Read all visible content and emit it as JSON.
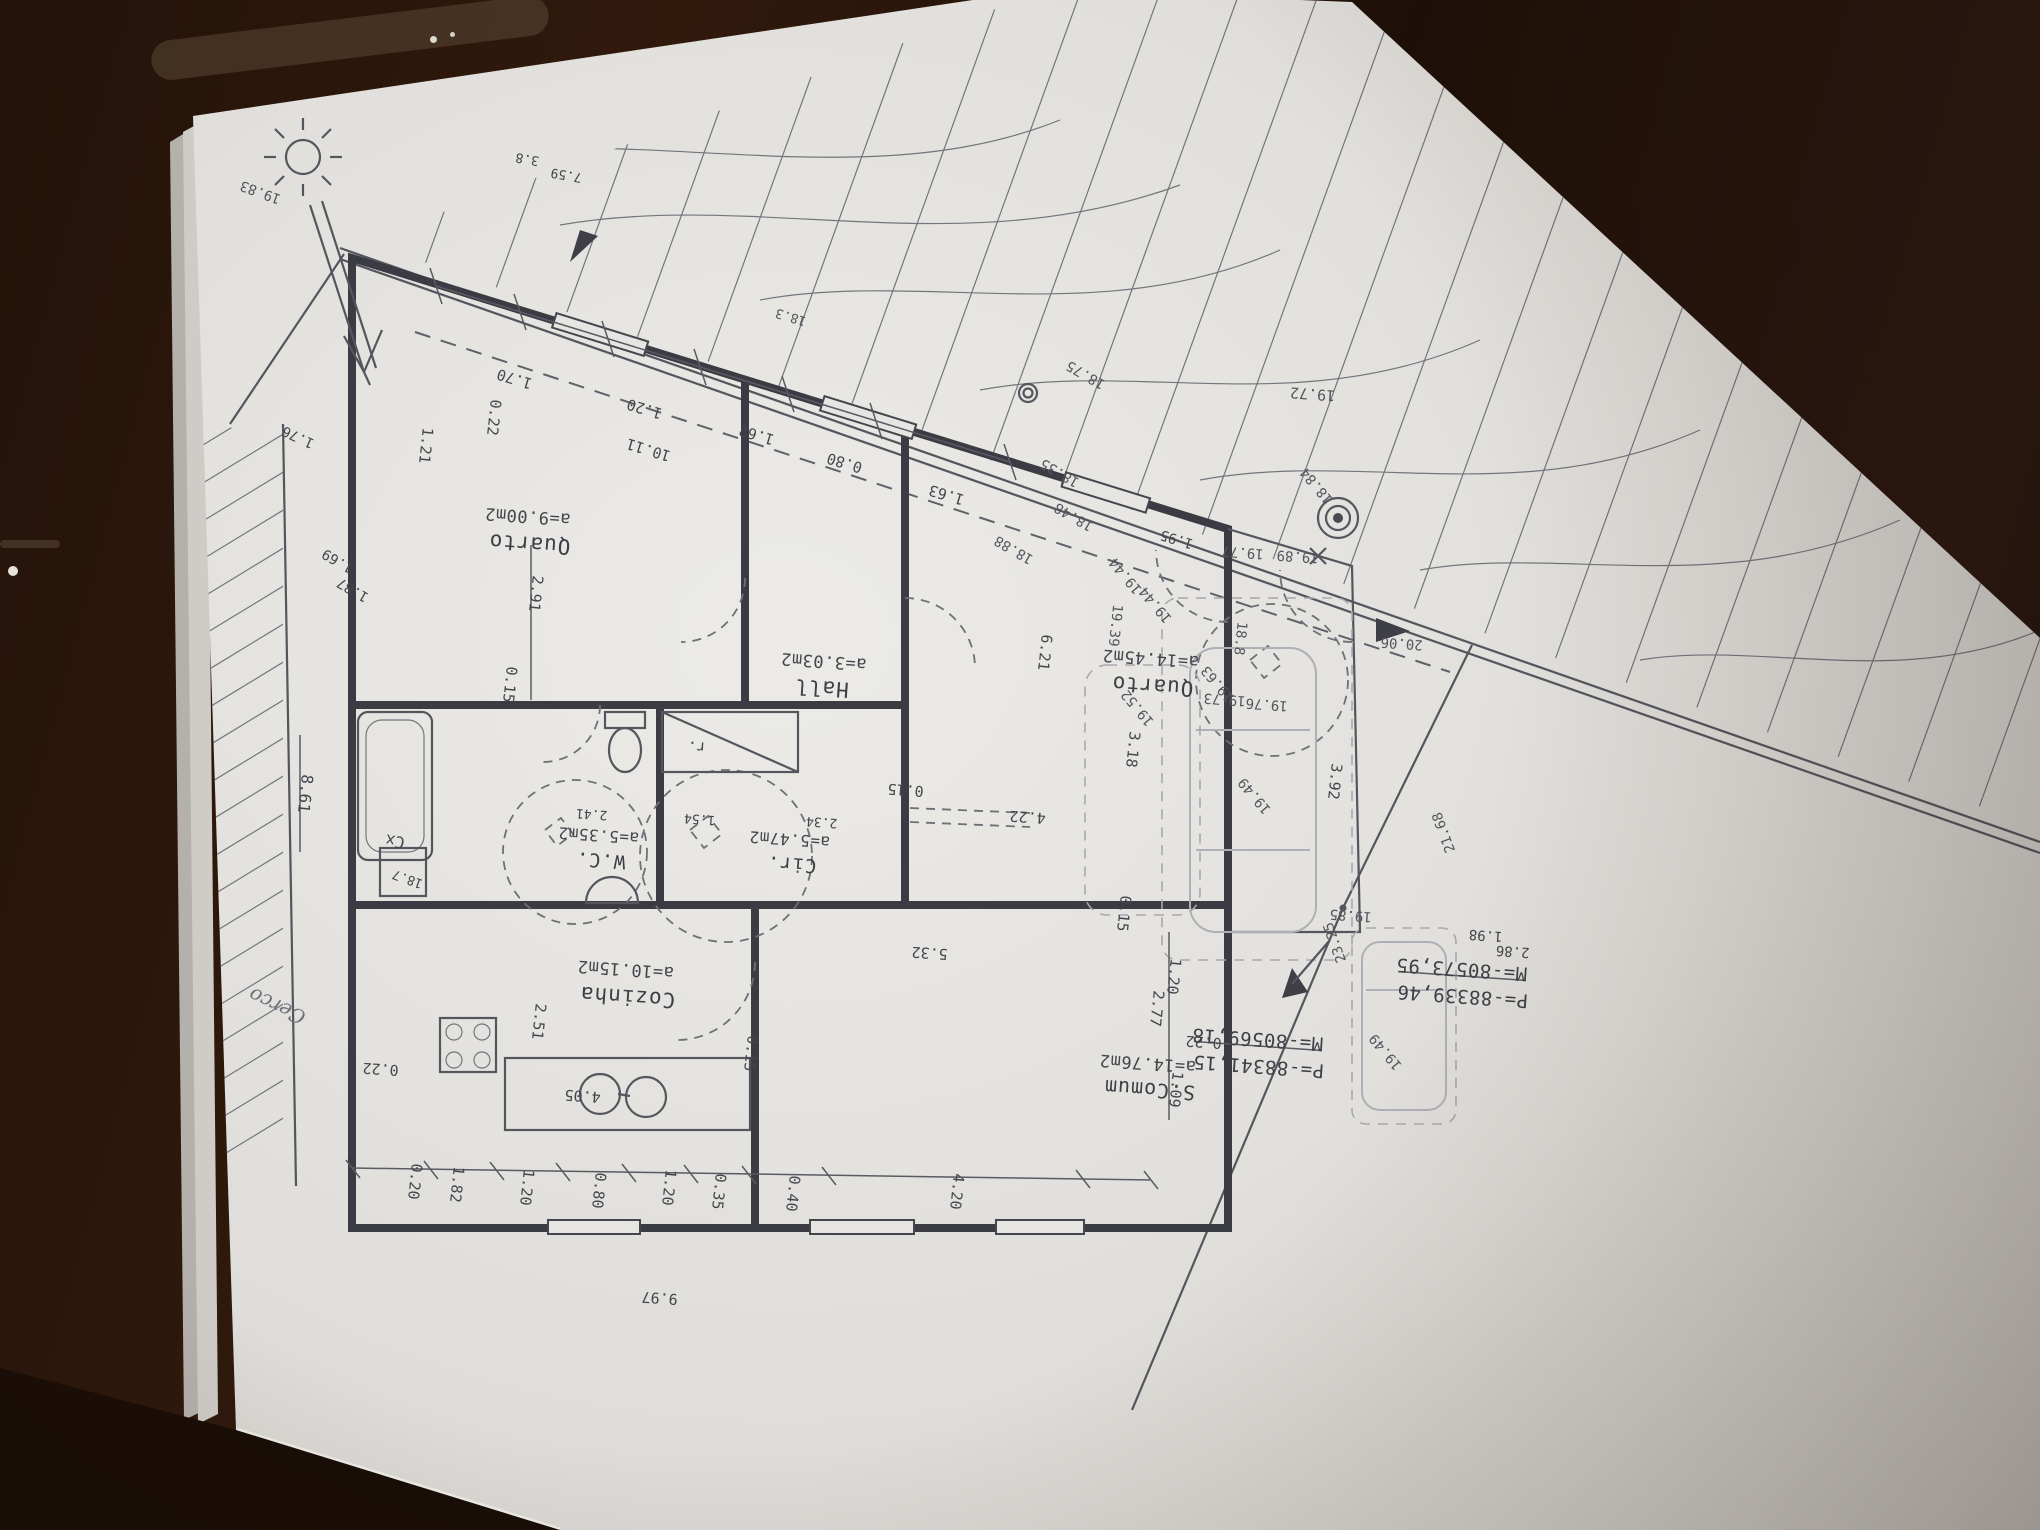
{
  "document": {
    "kind": "architectural floor plan photographed upside-down on a wooden table",
    "colors": {
      "table": "#2a1710",
      "paper": "#e3e1dd",
      "ink": "#45454d",
      "walls": "#3b3b43",
      "ghost": "#aeacb4"
    }
  },
  "rooms": [
    {
      "name": "Quarto",
      "area": "a=9.00m2"
    },
    {
      "name": "Hall",
      "area": "a=3.03m2"
    },
    {
      "name": "Quarto",
      "area": "a=14.45m2"
    },
    {
      "name": "W.C.",
      "area": "a=5.35m2"
    },
    {
      "name": "Cir.",
      "area": "a=5.47m2"
    },
    {
      "name": "Cozinha",
      "area": "a=10.15m2"
    },
    {
      "name": "S.Comum",
      "area": "a=14.76m2"
    }
  ],
  "survey_points": [
    {
      "m": "M=-80573,95",
      "p": "P=-88339,46"
    },
    {
      "m": "M=-80569,18",
      "p": "P=-88341,15"
    }
  ],
  "annotations": [
    {
      "t": "Quarto",
      "x": 530,
      "y": 537,
      "r": 184,
      "s": 21,
      "k": "room"
    },
    {
      "t": "a=9.00m2",
      "x": 528,
      "y": 511,
      "r": 184,
      "s": 17,
      "k": "area"
    },
    {
      "t": "Hall",
      "x": 822,
      "y": 681,
      "r": 184,
      "s": 21,
      "k": "room"
    },
    {
      "t": "a=3.03m2",
      "x": 824,
      "y": 656,
      "r": 184,
      "s": 17,
      "k": "area"
    },
    {
      "t": "Quarto",
      "x": 1153,
      "y": 679,
      "r": 184,
      "s": 21,
      "k": "room"
    },
    {
      "t": "a=14.45m2",
      "x": 1151,
      "y": 653,
      "r": 184,
      "s": 17,
      "k": "area"
    },
    {
      "t": "W.C.",
      "x": 601,
      "y": 854,
      "r": 184,
      "s": 19,
      "k": "room"
    },
    {
      "t": "a=5.35m2",
      "x": 599,
      "y": 830,
      "r": 184,
      "s": 16,
      "k": "area"
    },
    {
      "t": "Cir.",
      "x": 792,
      "y": 858,
      "r": 184,
      "s": 19,
      "k": "room"
    },
    {
      "t": "a=5.47m2",
      "x": 790,
      "y": 834,
      "r": 184,
      "s": 16,
      "k": "area"
    },
    {
      "t": "Cozinha",
      "x": 628,
      "y": 990,
      "r": 184,
      "s": 21,
      "k": "room"
    },
    {
      "t": "a=10.15m2",
      "x": 626,
      "y": 964,
      "r": 184,
      "s": 17,
      "k": "area"
    },
    {
      "t": "S.Comum",
      "x": 1150,
      "y": 1083,
      "r": 184,
      "s": 20,
      "k": "room"
    },
    {
      "t": "a=14.76m2",
      "x": 1148,
      "y": 1058,
      "r": 184,
      "s": 17,
      "k": "area"
    },
    {
      "t": "r.",
      "x": 697,
      "y": 742,
      "r": 184,
      "s": 15,
      "k": "fixture"
    },
    {
      "t": "Cx",
      "x": 396,
      "y": 836,
      "r": 190,
      "s": 16,
      "k": "fixture"
    },
    {
      "t": "1.70",
      "x": 516,
      "y": 374,
      "r": 197,
      "s": 15,
      "k": "dim"
    },
    {
      "t": "1.20",
      "x": 646,
      "y": 404,
      "r": 197,
      "s": 15,
      "k": "dim"
    },
    {
      "t": "10.11",
      "x": 650,
      "y": 445,
      "r": 197,
      "s": 15,
      "k": "dim"
    },
    {
      "t": "1.62",
      "x": 758,
      "y": 430,
      "r": 197,
      "s": 15,
      "k": "dim"
    },
    {
      "t": "0.80",
      "x": 846,
      "y": 458,
      "r": 197,
      "s": 15,
      "k": "dim"
    },
    {
      "t": "1.63",
      "x": 948,
      "y": 490,
      "r": 197,
      "s": 15,
      "k": "dim"
    },
    {
      "t": "0.22",
      "x": 489,
      "y": 417,
      "r": 96,
      "s": 15,
      "k": "dim"
    },
    {
      "t": "1.21",
      "x": 421,
      "y": 445,
      "r": 96,
      "s": 15,
      "k": "dim"
    },
    {
      "t": "2.91",
      "x": 531,
      "y": 593,
      "r": 96,
      "s": 15,
      "k": "dim"
    },
    {
      "t": "0.15",
      "x": 505,
      "y": 684,
      "r": 96,
      "s": 15,
      "k": "dim"
    },
    {
      "t": "0.15",
      "x": 906,
      "y": 785,
      "r": 184,
      "s": 15,
      "k": "dim"
    },
    {
      "t": "4.22",
      "x": 1028,
      "y": 812,
      "r": 184,
      "s": 15,
      "k": "dim"
    },
    {
      "t": "3.18",
      "x": 1128,
      "y": 749,
      "r": 96,
      "s": 15,
      "k": "dim"
    },
    {
      "t": "6.21",
      "x": 1040,
      "y": 652,
      "r": 96,
      "s": 15,
      "k": "dim"
    },
    {
      "t": "3.92",
      "x": 1330,
      "y": 781,
      "r": 96,
      "s": 15,
      "k": "dim"
    },
    {
      "t": "0.15",
      "x": 1119,
      "y": 913,
      "r": 96,
      "s": 15,
      "k": "dim"
    },
    {
      "t": "2.77",
      "x": 1152,
      "y": 1008,
      "r": 96,
      "s": 15,
      "k": "dim"
    },
    {
      "t": "5.32",
      "x": 930,
      "y": 948,
      "r": 184,
      "s": 15,
      "k": "dim"
    },
    {
      "t": "1.20",
      "x": 1169,
      "y": 976,
      "r": 96,
      "s": 15,
      "k": "dim"
    },
    {
      "t": "0.22",
      "x": 1204,
      "y": 1037,
      "r": 184,
      "s": 15,
      "k": "dim"
    },
    {
      "t": "1.09",
      "x": 1171,
      "y": 1089,
      "r": 96,
      "s": 15,
      "k": "dim"
    },
    {
      "t": "2.51",
      "x": 534,
      "y": 1021,
      "r": 96,
      "s": 15,
      "k": "dim"
    },
    {
      "t": "0.15",
      "x": 746,
      "y": 1053,
      "r": 96,
      "s": 15,
      "k": "dim"
    },
    {
      "t": "4.05",
      "x": 583,
      "y": 1091,
      "r": 184,
      "s": 15,
      "k": "dim"
    },
    {
      "t": "0.22",
      "x": 381,
      "y": 1064,
      "r": 184,
      "s": 15,
      "k": "dim"
    },
    {
      "t": "0.20",
      "x": 410,
      "y": 1181,
      "r": 96,
      "s": 15,
      "k": "dim"
    },
    {
      "t": "1.82",
      "x": 452,
      "y": 1184,
      "r": 96,
      "s": 15,
      "k": "dim"
    },
    {
      "t": "1.20",
      "x": 522,
      "y": 1187,
      "r": 96,
      "s": 15,
      "k": "dim"
    },
    {
      "t": "0.80",
      "x": 594,
      "y": 1190,
      "r": 96,
      "s": 15,
      "k": "dim"
    },
    {
      "t": "1.20",
      "x": 664,
      "y": 1187,
      "r": 96,
      "s": 15,
      "k": "dim"
    },
    {
      "t": "0.35",
      "x": 714,
      "y": 1191,
      "r": 96,
      "s": 15,
      "k": "dim"
    },
    {
      "t": "0.40",
      "x": 788,
      "y": 1193,
      "r": 96,
      "s": 15,
      "k": "dim"
    },
    {
      "t": "4.20",
      "x": 952,
      "y": 1191,
      "r": 96,
      "s": 15,
      "k": "dim"
    },
    {
      "t": "9.97",
      "x": 660,
      "y": 1293,
      "r": 184,
      "s": 15,
      "k": "dim"
    },
    {
      "t": "2.41",
      "x": 592,
      "y": 810,
      "r": 184,
      "s": 13,
      "k": "dim"
    },
    {
      "t": "1.54",
      "x": 700,
      "y": 815,
      "r": 184,
      "s": 13,
      "k": "dim"
    },
    {
      "t": "2.34",
      "x": 822,
      "y": 818,
      "r": 184,
      "s": 13,
      "k": "dim"
    },
    {
      "t": "8.61",
      "x": 300,
      "y": 793,
      "r": 96,
      "s": 16,
      "k": "dim"
    },
    {
      "t": "1.76",
      "x": 300,
      "y": 433,
      "r": 205,
      "s": 14,
      "k": "dim"
    },
    {
      "t": "1.69",
      "x": 340,
      "y": 557,
      "r": 210,
      "s": 14,
      "k": "dim"
    },
    {
      "t": "1.87",
      "x": 355,
      "y": 586,
      "r": 210,
      "s": 14,
      "k": "dim"
    },
    {
      "t": "18.7",
      "x": 409,
      "y": 875,
      "r": 200,
      "s": 13,
      "k": "dim"
    },
    {
      "t": "19.83",
      "x": 262,
      "y": 188,
      "r": 200,
      "s": 14,
      "k": "elev"
    },
    {
      "t": "3.8",
      "x": 528,
      "y": 155,
      "r": 190,
      "s": 13,
      "k": "dim"
    },
    {
      "t": "7.59",
      "x": 567,
      "y": 171,
      "r": 190,
      "s": 13,
      "k": "dim"
    },
    {
      "t": "18.3",
      "x": 792,
      "y": 313,
      "r": 197,
      "s": 13,
      "k": "elev"
    },
    {
      "t": "18.35",
      "x": 1062,
      "y": 469,
      "r": 210,
      "s": 14,
      "k": "elev"
    },
    {
      "t": "18.48",
      "x": 1076,
      "y": 513,
      "r": 210,
      "s": 14,
      "k": "elev"
    },
    {
      "t": "1.95",
      "x": 1178,
      "y": 535,
      "r": 197,
      "s": 14,
      "k": "dim"
    },
    {
      "t": "18.88",
      "x": 1016,
      "y": 546,
      "r": 210,
      "s": 14,
      "k": "elev"
    },
    {
      "t": "18.84",
      "x": 1320,
      "y": 483,
      "r": 230,
      "s": 14,
      "k": "elev"
    },
    {
      "t": "18.75",
      "x": 1088,
      "y": 371,
      "r": 210,
      "s": 14,
      "k": "elev"
    },
    {
      "t": "18.8",
      "x": 1236,
      "y": 638,
      "r": 96,
      "s": 14,
      "k": "elev"
    },
    {
      "t": "19.72",
      "x": 1313,
      "y": 389,
      "r": 184,
      "s": 15,
      "k": "elev"
    },
    {
      "t": "19.77",
      "x": 1243,
      "y": 548,
      "r": 184,
      "s": 14,
      "k": "elev"
    },
    {
      "t": "19.89",
      "x": 1298,
      "y": 552,
      "r": 184,
      "s": 14,
      "k": "elev"
    },
    {
      "t": "20.06",
      "x": 1402,
      "y": 639,
      "r": 184,
      "s": 14,
      "k": "elev"
    },
    {
      "t": "19.44",
      "x": 1129,
      "y": 573,
      "r": 230,
      "s": 14,
      "k": "elev"
    },
    {
      "t": "19.44",
      "x": 1159,
      "y": 602,
      "r": 230,
      "s": 14,
      "k": "elev"
    },
    {
      "t": "19.39",
      "x": 1111,
      "y": 625,
      "r": 96,
      "s": 14,
      "k": "elev"
    },
    {
      "t": "19.52",
      "x": 1141,
      "y": 705,
      "r": 230,
      "s": 14,
      "k": "elev"
    },
    {
      "t": "19.63",
      "x": 1221,
      "y": 681,
      "r": 230,
      "s": 14,
      "k": "elev"
    },
    {
      "t": "19.73",
      "x": 1225,
      "y": 695,
      "r": 184,
      "s": 14,
      "k": "elev"
    },
    {
      "t": "19.76",
      "x": 1267,
      "y": 700,
      "r": 184,
      "s": 14,
      "k": "elev"
    },
    {
      "t": "19.49",
      "x": 1258,
      "y": 793,
      "r": 230,
      "s": 14,
      "k": "elev"
    },
    {
      "t": "19.49",
      "x": 1389,
      "y": 1049,
      "r": 230,
      "s": 14,
      "k": "elev"
    },
    {
      "t": "21.68",
      "x": 1448,
      "y": 831,
      "r": 250,
      "s": 14,
      "k": "elev"
    },
    {
      "t": "19.85",
      "x": 1351,
      "y": 911,
      "r": 184,
      "s": 14,
      "k": "elev"
    },
    {
      "t": "23.25",
      "x": 1339,
      "y": 941,
      "r": 250,
      "s": 14,
      "k": "elev"
    },
    {
      "t": "1.98",
      "x": 1486,
      "y": 931,
      "r": 184,
      "s": 14,
      "k": "dim"
    },
    {
      "t": "2.86",
      "x": 1513,
      "y": 947,
      "r": 184,
      "s": 14,
      "k": "dim"
    },
    {
      "t": "M=-80573,95",
      "x": 1462,
      "y": 963,
      "r": 184,
      "s": 19,
      "k": "coord"
    },
    {
      "t": "P=-88339,46",
      "x": 1463,
      "y": 990,
      "r": 184,
      "s": 19,
      "k": "coord"
    },
    {
      "t": "M=-80569,18",
      "x": 1258,
      "y": 1033,
      "r": 184,
      "s": 19,
      "k": "coord"
    },
    {
      "t": "P=-88341,15",
      "x": 1259,
      "y": 1060,
      "r": 184,
      "s": 19,
      "k": "coord"
    },
    {
      "t": "Cerco",
      "x": 280,
      "y": 1000,
      "r": 205,
      "s": 20,
      "k": "note"
    }
  ]
}
